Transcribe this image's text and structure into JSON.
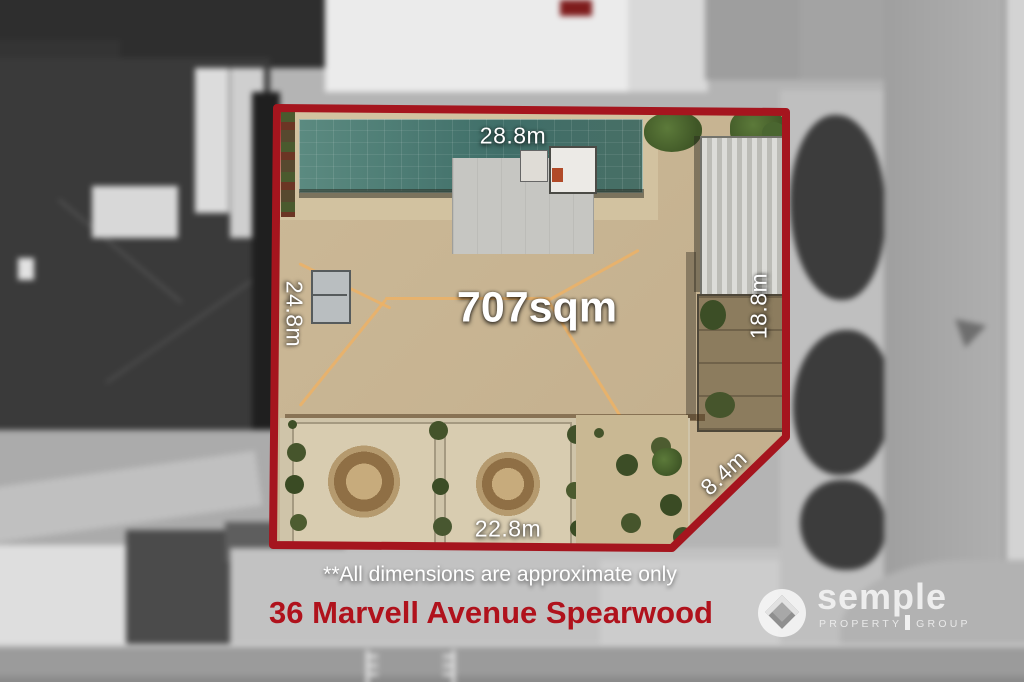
{
  "overlay": {
    "area": "707sqm",
    "dim_top": "28.8m",
    "dim_left": "24.8m",
    "dim_right": "18.8m",
    "dim_diagonal": "8.4m",
    "dim_bottom": "22.8m",
    "disclaimer": "**All dimensions are approximate only",
    "address": "36 Marvell Avenue Spearwood"
  },
  "logo": {
    "name": "semple",
    "tagline_left": "PROPERTY",
    "tagline_right": "GROUP"
  },
  "colors": {
    "boundary_red": "#a5151e",
    "address_red": "#b0121c",
    "dimension_text": "#ffffff",
    "roof_orange": "#c97420",
    "pool_teal": "#4a766e"
  }
}
